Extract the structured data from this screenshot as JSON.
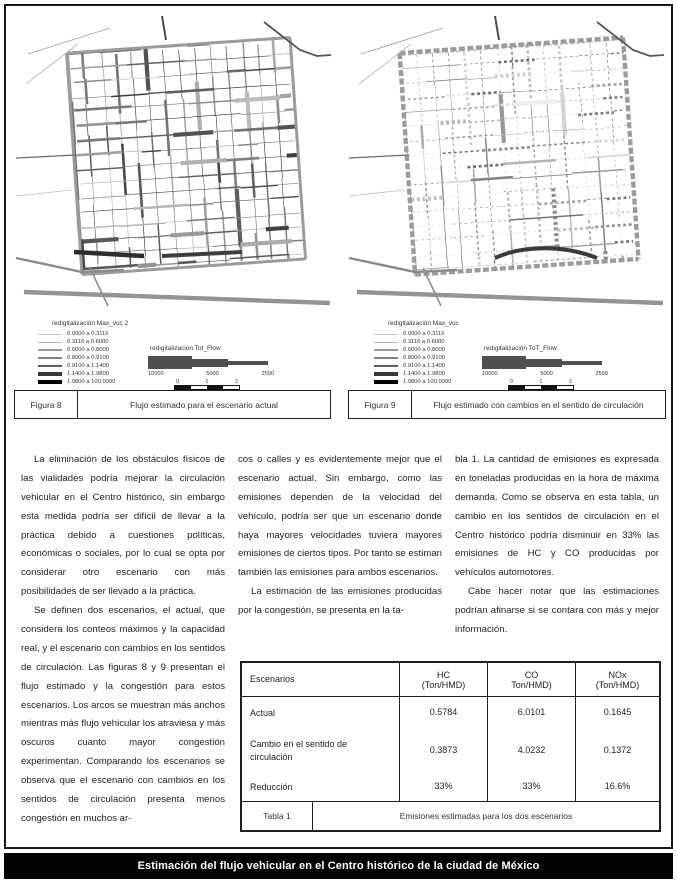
{
  "page": {
    "footer_title": "Estimación del flujo vehicular en el Centro histórico de la ciudad de México"
  },
  "figures": [
    {
      "id_label": "Figura 8",
      "caption": "Flujo estimado para el escenario actual",
      "legend": {
        "title": "redigitalización Max_voc 2",
        "items": [
          "0.0000 a 0.3116",
          "0.3116 a 0.6000",
          "0.6000 a 0.8000",
          "0.8000 a 0.9100",
          "0.9100 a 1.1400",
          "1.1400 a 1.9800",
          "1.9800 a 100.0000"
        ]
      },
      "flow_legend": {
        "title": "redigitalización Tot_Flow",
        "values": [
          "10000",
          "5000",
          "2500"
        ],
        "scale_ticks": [
          "0",
          "1",
          "2"
        ],
        "scale_unit": "kilometros"
      }
    },
    {
      "id_label": "Figura 9",
      "caption": "Flujo estimado con cambios en el sentido de circulación",
      "legend": {
        "title": "redigitalización Max_voc",
        "items": [
          "0.0000 a 0.3116",
          "0.3116 a 0.6000",
          "0.6000 a 0.8000",
          "0.8000 a 0.9100",
          "0.9100 a 1.1400",
          "1.1400 a 1.9800",
          "1.9800 a 100.0000"
        ]
      },
      "flow_legend": {
        "title": "redigitalización ToT_Flow",
        "values": [
          "10000",
          "5000",
          "2500"
        ],
        "scale_ticks": [
          "0",
          "1",
          "2"
        ],
        "scale_unit": "kilometros"
      }
    }
  ],
  "article": {
    "columns": [
      {
        "paragraphs": [
          {
            "indent": true,
            "text": "La eliminación de los obstáculos físicos de las vialidades podría mejorar la circulación vehicular en el Centro histórico, sin embargo esta medida podría ser difícil de llevar a la práctica debido a cuestiones políticas, económicas o sociales, por lo cual se opta por considerar otro escenario con más posibilidades de ser llevado a la práctica."
          },
          {
            "indent": true,
            "text": "Se definen dos escenarios, el actual, que considera los conteos máximos y la capacidad real, y el escenario con cambios en los sentidos de circulación. Las figuras 8 y 9 presentan el flujo estimado y la congestión para estos escenarios. Los arcos se muestran más anchos mientras más flujo vehicular los atraviesa y más oscuros cuanto mayor congestión experimentan. Comparando los escenarios se observa que el escenario con cambios en los sentidos de circulación presenta menos congestión en muchos ar-"
          }
        ]
      },
      {
        "paragraphs": [
          {
            "indent": false,
            "text": "cos o calles y es evidentemente mejor que el escenario actual. Sin embargo, como las emisiones dependen de la velocidad del vehículo, podría ser que un escenario donde haya mayores velocidades tuviera mayores emisiones de ciertos tipos. Por tanto se estiman también las emisiones para ambos escenarios."
          },
          {
            "indent": true,
            "text": "La estimación de las emisiones producidas por la congestión, se presenta en la ta-"
          }
        ]
      },
      {
        "paragraphs": [
          {
            "indent": false,
            "text": "bla 1. La cantidad de emisiones es expresada en toneladas producidas en la hora de máxima demanda. Como se observa en esta tabla, un cambio en los sentidos de circulación en el Centro histórico podría disminuir en 33% las emisiones de HC y CO producidas por vehículos automotores."
          },
          {
            "indent": true,
            "text": "Cabe hacer notar que las estimaciones podrían afinarse si se contara con más y mejor información."
          }
        ]
      }
    ]
  },
  "table": {
    "headers": [
      {
        "line1": "Escenarios",
        "line2": ""
      },
      {
        "line1": "HC",
        "line2": "(Ton/HMD)"
      },
      {
        "line1": "CO",
        "line2": "Ton/HMD)"
      },
      {
        "line1": "NOx",
        "line2": "(Ton/HMD)"
      }
    ],
    "rows": [
      {
        "label": "Actual",
        "values": [
          "0.5784",
          "6.0101",
          "0.1645"
        ]
      },
      {
        "label": "Cambio en el sentido de circulación",
        "values": [
          "0.3873",
          "4.0232",
          "0.1372"
        ]
      },
      {
        "label": "Reducción",
        "values": [
          "33%",
          "33%",
          "16.6%"
        ]
      }
    ],
    "caption_id": "Tabla 1",
    "caption": "Emisiones estimadas para los dos escenarios"
  },
  "colors": {
    "ink": "#1f1f1f",
    "footer_bg": "#020202",
    "footer_text": "#ffffff"
  }
}
